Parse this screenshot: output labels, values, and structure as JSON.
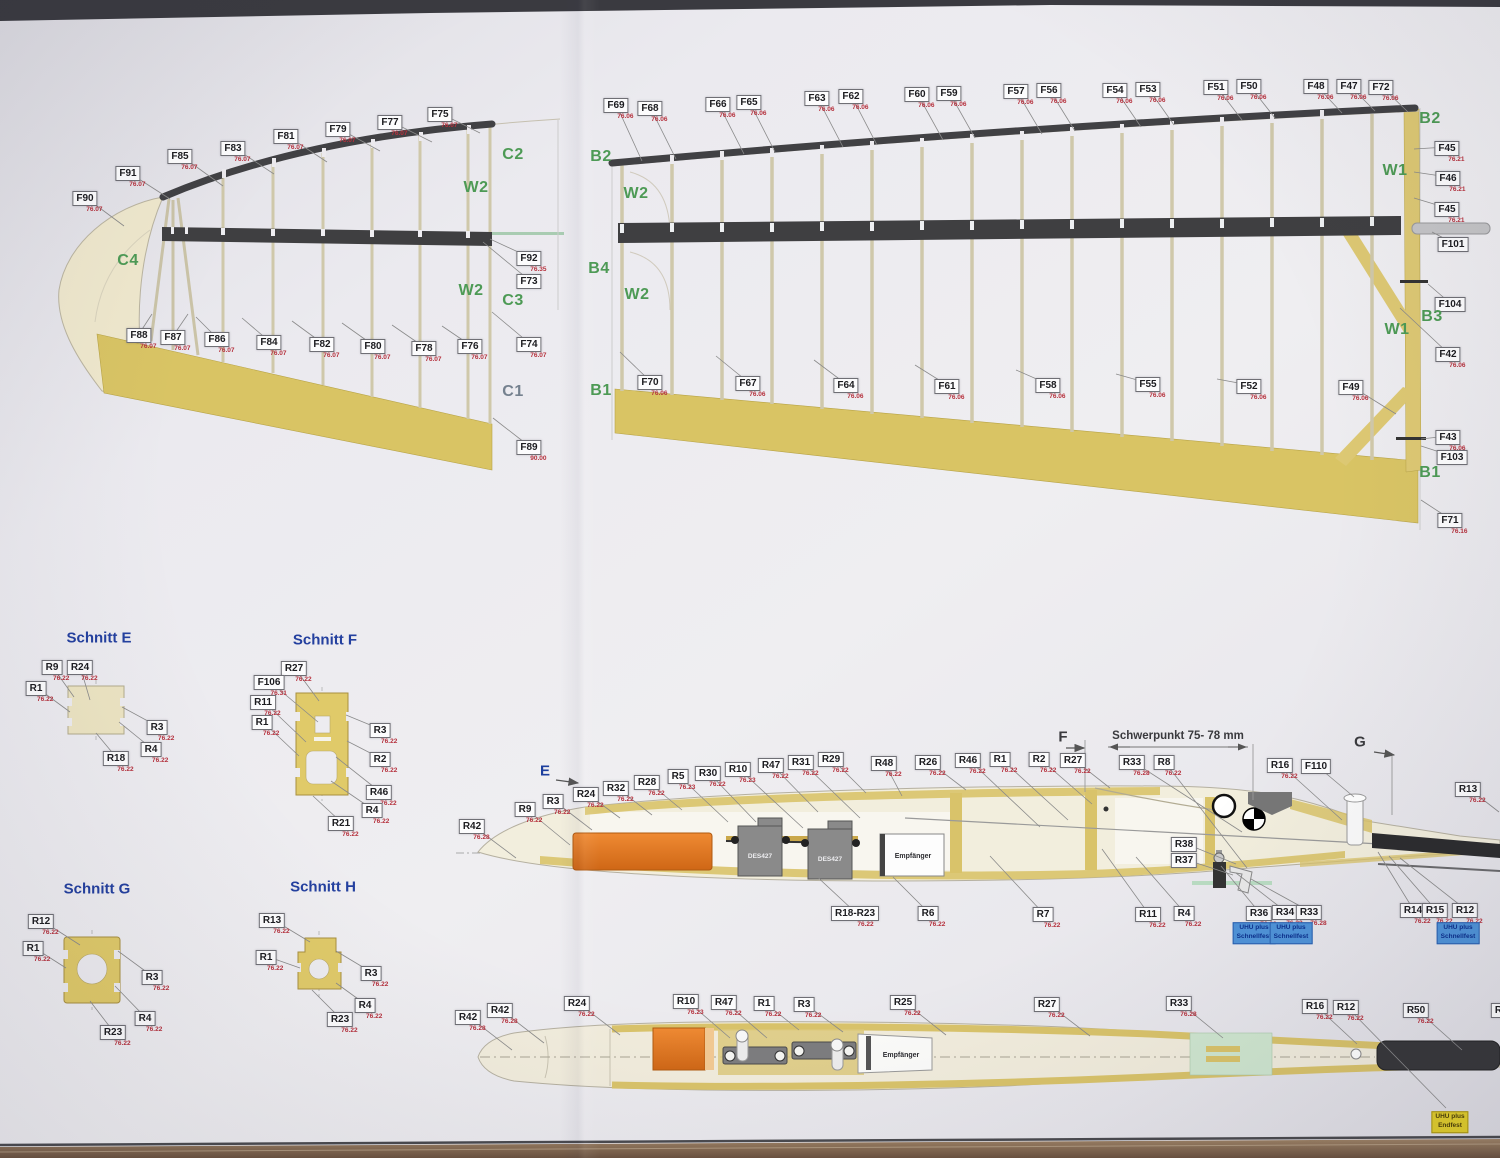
{
  "texts": {
    "servo": "DES427",
    "receiver": "Empfänger",
    "cg_dimension": "Schwerpunkt 75- 78 mm"
  },
  "section_titles": [
    {
      "label": "Schnitt E",
      "x": 99,
      "y": 638
    },
    {
      "label": "Schnitt F",
      "x": 325,
      "y": 640
    },
    {
      "label": "Schnitt G",
      "x": 97,
      "y": 889
    },
    {
      "label": "Schnitt H",
      "x": 323,
      "y": 887
    }
  ],
  "markers": [
    {
      "label": "E",
      "x": 545,
      "y": 771,
      "color": "#1d3f9e",
      "arrow": [
        556,
        780,
        578,
        783
      ]
    },
    {
      "label": "F",
      "x": 1063,
      "y": 737,
      "color": "#3a3a3e",
      "arrow": [
        1066,
        748,
        1084,
        748
      ]
    },
    {
      "label": "G",
      "x": 1360,
      "y": 742,
      "color": "#3a3a3e",
      "arrow": [
        1374,
        752,
        1394,
        755
      ]
    }
  ],
  "green_letters": [
    {
      "label": "C2",
      "x": 513,
      "y": 155,
      "color": "#4d9a55"
    },
    {
      "label": "W2",
      "x": 476,
      "y": 188,
      "color": "#4d9a55"
    },
    {
      "label": "C4",
      "x": 128,
      "y": 261,
      "color": "#4d9a55"
    },
    {
      "label": "W2",
      "x": 471,
      "y": 291,
      "color": "#4d9a55"
    },
    {
      "label": "C3",
      "x": 513,
      "y": 301,
      "color": "#4d9a55"
    },
    {
      "label": "C1",
      "x": 513,
      "y": 392,
      "color": "#75818f"
    },
    {
      "label": "B2",
      "x": 601,
      "y": 157,
      "color": "#4d9a55"
    },
    {
      "label": "W2",
      "x": 636,
      "y": 194,
      "color": "#4d9a55"
    },
    {
      "label": "B4",
      "x": 599,
      "y": 269,
      "color": "#4d9a55"
    },
    {
      "label": "W2",
      "x": 637,
      "y": 295,
      "color": "#4d9a55"
    },
    {
      "label": "B1",
      "x": 601,
      "y": 391,
      "color": "#4d9a55"
    },
    {
      "label": "B2",
      "x": 1430,
      "y": 119,
      "color": "#4d9a55"
    },
    {
      "label": "W1",
      "x": 1395,
      "y": 171,
      "color": "#4d9a55"
    },
    {
      "label": "B3",
      "x": 1432,
      "y": 317,
      "color": "#4d9a55"
    },
    {
      "label": "W1",
      "x": 1397,
      "y": 330,
      "color": "#4d9a55"
    },
    {
      "label": "B1",
      "x": 1430,
      "y": 473,
      "color": "#4d9a55"
    }
  ],
  "glue_boxes": [
    {
      "lines": [
        "UHU plus",
        "Schnellfest"
      ],
      "style": "blue",
      "x": 1254,
      "y": 933
    },
    {
      "lines": [
        "UHU plus",
        "Schnellfest"
      ],
      "style": "blue",
      "x": 1291,
      "y": 933
    },
    {
      "lines": [
        "UHU plus",
        "Schnellfest"
      ],
      "style": "blue",
      "x": 1458,
      "y": 933
    },
    {
      "lines": [
        "UHU plus",
        "Endfest"
      ],
      "style": "yellow",
      "x": 1450,
      "y": 1122
    }
  ],
  "part_labels": [
    {
      "t": "F90",
      "s": "76.07",
      "x": 85,
      "y": 197,
      "l": [
        124,
        226
      ]
    },
    {
      "t": "F91",
      "s": "76.07",
      "x": 128,
      "y": 172,
      "l": [
        170,
        199
      ]
    },
    {
      "t": "F85",
      "s": "76.07",
      "x": 180,
      "y": 155,
      "l": [
        223,
        186
      ]
    },
    {
      "t": "F83",
      "s": "76.07",
      "x": 233,
      "y": 147,
      "l": [
        274,
        174
      ]
    },
    {
      "t": "F81",
      "s": "76.07",
      "x": 286,
      "y": 135,
      "l": [
        327,
        162
      ]
    },
    {
      "t": "F79",
      "s": "76.07",
      "x": 338,
      "y": 128,
      "l": [
        380,
        151
      ]
    },
    {
      "t": "F77",
      "s": "76.07",
      "x": 390,
      "y": 121,
      "l": [
        432,
        142
      ]
    },
    {
      "t": "F75",
      "s": "76.07",
      "x": 440,
      "y": 113,
      "l": [
        480,
        133
      ]
    },
    {
      "t": "F92",
      "s": "76.35",
      "x": 529,
      "y": 257,
      "l": [
        490,
        239
      ]
    },
    {
      "t": "F73",
      "s": "",
      "x": 529,
      "y": 280,
      "l": [
        483,
        242
      ]
    },
    {
      "t": "F88",
      "s": "76.07",
      "x": 139,
      "y": 334,
      "l": [
        152,
        314
      ]
    },
    {
      "t": "F87",
      "s": "76.07",
      "x": 173,
      "y": 336,
      "l": [
        188,
        314
      ]
    },
    {
      "t": "F86",
      "s": "76.07",
      "x": 217,
      "y": 338,
      "l": [
        196,
        317
      ]
    },
    {
      "t": "F84",
      "s": "76.07",
      "x": 269,
      "y": 341,
      "l": [
        242,
        318
      ]
    },
    {
      "t": "F82",
      "s": "76.07",
      "x": 322,
      "y": 343,
      "l": [
        292,
        321
      ]
    },
    {
      "t": "F80",
      "s": "76.07",
      "x": 373,
      "y": 345,
      "l": [
        342,
        323
      ]
    },
    {
      "t": "F78",
      "s": "76.07",
      "x": 424,
      "y": 347,
      "l": [
        392,
        325
      ]
    },
    {
      "t": "F76",
      "s": "76.07",
      "x": 470,
      "y": 345,
      "l": [
        442,
        326
      ]
    },
    {
      "t": "F74",
      "s": "76.07",
      "x": 529,
      "y": 343,
      "l": [
        492,
        312
      ]
    },
    {
      "t": "F89",
      "s": "90.00",
      "x": 529,
      "y": 446,
      "l": [
        493,
        418
      ]
    },
    {
      "t": "F69",
      "s": "76.06",
      "x": 616,
      "y": 104,
      "l": [
        642,
        161
      ]
    },
    {
      "t": "F68",
      "s": "76.06",
      "x": 650,
      "y": 107,
      "l": [
        676,
        159
      ]
    },
    {
      "t": "F66",
      "s": "76.06",
      "x": 718,
      "y": 103,
      "l": [
        744,
        154
      ]
    },
    {
      "t": "F65",
      "s": "76.06",
      "x": 749,
      "y": 101,
      "l": [
        775,
        152
      ]
    },
    {
      "t": "F63",
      "s": "76.06",
      "x": 817,
      "y": 97,
      "l": [
        843,
        147
      ]
    },
    {
      "t": "F62",
      "s": "76.06",
      "x": 851,
      "y": 95,
      "l": [
        877,
        145
      ]
    },
    {
      "t": "F60",
      "s": "76.06",
      "x": 917,
      "y": 93,
      "l": [
        943,
        140
      ]
    },
    {
      "t": "F59",
      "s": "76.06",
      "x": 949,
      "y": 92,
      "l": [
        975,
        138
      ]
    },
    {
      "t": "F57",
      "s": "76.06",
      "x": 1016,
      "y": 90,
      "l": [
        1042,
        134
      ]
    },
    {
      "t": "F56",
      "s": "76.06",
      "x": 1049,
      "y": 89,
      "l": [
        1075,
        131
      ]
    },
    {
      "t": "F54",
      "s": "76.06",
      "x": 1115,
      "y": 89,
      "l": [
        1141,
        127
      ]
    },
    {
      "t": "F53",
      "s": "76.06",
      "x": 1148,
      "y": 88,
      "l": [
        1174,
        125
      ]
    },
    {
      "t": "F51",
      "s": "76.06",
      "x": 1216,
      "y": 86,
      "l": [
        1242,
        120
      ]
    },
    {
      "t": "F50",
      "s": "76.06",
      "x": 1249,
      "y": 85,
      "l": [
        1275,
        118
      ]
    },
    {
      "t": "F48",
      "s": "76.06",
      "x": 1316,
      "y": 85,
      "l": [
        1342,
        113
      ]
    },
    {
      "t": "F47",
      "s": "76.06",
      "x": 1349,
      "y": 85,
      "l": [
        1375,
        111
      ]
    },
    {
      "t": "F72",
      "s": "76.06",
      "x": 1381,
      "y": 86,
      "l": [
        1408,
        112
      ]
    },
    {
      "t": "F70",
      "s": "76.06",
      "x": 650,
      "y": 381,
      "l": [
        620,
        352
      ]
    },
    {
      "t": "F67",
      "s": "76.06",
      "x": 748,
      "y": 382,
      "l": [
        716,
        356
      ]
    },
    {
      "t": "F64",
      "s": "76.06",
      "x": 846,
      "y": 384,
      "l": [
        814,
        360
      ]
    },
    {
      "t": "F61",
      "s": "76.06",
      "x": 947,
      "y": 385,
      "l": [
        915,
        365
      ]
    },
    {
      "t": "F58",
      "s": "76.06",
      "x": 1048,
      "y": 384,
      "l": [
        1016,
        370
      ]
    },
    {
      "t": "F55",
      "s": "76.06",
      "x": 1148,
      "y": 383,
      "l": [
        1116,
        374
      ]
    },
    {
      "t": "F52",
      "s": "76.06",
      "x": 1249,
      "y": 385,
      "l": [
        1217,
        379
      ]
    },
    {
      "t": "F49",
      "s": "76.06",
      "x": 1351,
      "y": 386,
      "l": [
        1396,
        414
      ]
    },
    {
      "t": "F45",
      "s": "76.21",
      "x": 1447,
      "y": 147,
      "l": [
        1414,
        149
      ]
    },
    {
      "t": "F46",
      "s": "76.21",
      "x": 1448,
      "y": 177,
      "l": [
        1414,
        172
      ]
    },
    {
      "t": "F45",
      "s": "76.21",
      "x": 1447,
      "y": 208,
      "l": [
        1414,
        198
      ]
    },
    {
      "t": "F101",
      "s": "",
      "x": 1453,
      "y": 243,
      "l": [
        1432,
        232
      ]
    },
    {
      "t": "F104",
      "s": "",
      "x": 1450,
      "y": 303,
      "l": [
        1428,
        284
      ]
    },
    {
      "t": "F42",
      "s": "76.06",
      "x": 1448,
      "y": 353,
      "l": [
        1400,
        308
      ]
    },
    {
      "t": "F43",
      "s": "76.06",
      "x": 1448,
      "y": 436,
      "l": [
        1421,
        439
      ]
    },
    {
      "t": "F103",
      "s": "",
      "x": 1452,
      "y": 456,
      "l": [
        1421,
        446
      ]
    },
    {
      "t": "F71",
      "s": "76.16",
      "x": 1450,
      "y": 519,
      "l": [
        1421,
        500
      ]
    },
    {
      "t": "R9",
      "s": "76.22",
      "x": 52,
      "y": 666,
      "l": [
        74,
        697
      ]
    },
    {
      "t": "R24",
      "s": "76.22",
      "x": 80,
      "y": 666,
      "l": [
        90,
        700
      ]
    },
    {
      "t": "R1",
      "s": "76.22",
      "x": 36,
      "y": 687,
      "l": [
        70,
        712
      ]
    },
    {
      "t": "R3",
      "s": "76.22",
      "x": 157,
      "y": 726,
      "l": [
        122,
        707
      ]
    },
    {
      "t": "R4",
      "s": "76.22",
      "x": 151,
      "y": 748,
      "l": [
        119,
        722
      ]
    },
    {
      "t": "R18",
      "s": "76.22",
      "x": 116,
      "y": 757,
      "l": [
        96,
        733
      ]
    },
    {
      "t": "R27",
      "s": "76.22",
      "x": 294,
      "y": 667,
      "l": [
        319,
        701
      ]
    },
    {
      "t": "F106",
      "s": "76.31",
      "x": 269,
      "y": 681,
      "l": [
        318,
        722
      ]
    },
    {
      "t": "R11",
      "s": "76.22",
      "x": 263,
      "y": 701,
      "l": [
        306,
        742
      ]
    },
    {
      "t": "R1",
      "s": "76.22",
      "x": 262,
      "y": 721,
      "l": [
        299,
        756
      ]
    },
    {
      "t": "R3",
      "s": "76.22",
      "x": 380,
      "y": 729,
      "l": [
        346,
        715
      ]
    },
    {
      "t": "R2",
      "s": "76.22",
      "x": 380,
      "y": 758,
      "l": [
        347,
        741
      ]
    },
    {
      "t": "R46",
      "s": "76.22",
      "x": 379,
      "y": 791,
      "l": [
        336,
        757
      ]
    },
    {
      "t": "R4",
      "s": "76.22",
      "x": 372,
      "y": 809,
      "l": [
        331,
        781
      ]
    },
    {
      "t": "R21",
      "s": "76.22",
      "x": 341,
      "y": 822,
      "l": [
        313,
        796
      ]
    },
    {
      "t": "R12",
      "s": "76.22",
      "x": 41,
      "y": 920,
      "l": [
        80,
        945
      ]
    },
    {
      "t": "R1",
      "s": "76.22",
      "x": 33,
      "y": 947,
      "l": [
        66,
        968
      ]
    },
    {
      "t": "R3",
      "s": "76.22",
      "x": 152,
      "y": 976,
      "l": [
        118,
        951
      ]
    },
    {
      "t": "R4",
      "s": "76.22",
      "x": 145,
      "y": 1017,
      "l": [
        115,
        986
      ]
    },
    {
      "t": "R23",
      "s": "76.22",
      "x": 113,
      "y": 1031,
      "l": [
        90,
        1001
      ]
    },
    {
      "t": "R13",
      "s": "76.22",
      "x": 272,
      "y": 919,
      "l": [
        310,
        942
      ]
    },
    {
      "t": "R1",
      "s": "76.22",
      "x": 266,
      "y": 956,
      "l": [
        300,
        968
      ]
    },
    {
      "t": "R3",
      "s": "76.22",
      "x": 371,
      "y": 972,
      "l": [
        336,
        951
      ]
    },
    {
      "t": "R4",
      "s": "76.22",
      "x": 365,
      "y": 1004,
      "l": [
        336,
        983
      ]
    },
    {
      "t": "R23",
      "s": "76.22",
      "x": 340,
      "y": 1018,
      "l": [
        312,
        990
      ]
    },
    {
      "t": "R42",
      "s": "76.28",
      "x": 472,
      "y": 825,
      "l": [
        516,
        858
      ]
    },
    {
      "t": "R9",
      "s": "76.22",
      "x": 525,
      "y": 808,
      "l": [
        570,
        845
      ]
    },
    {
      "t": "R3",
      "s": "76.22",
      "x": 553,
      "y": 800,
      "l": [
        592,
        830
      ]
    },
    {
      "t": "R24",
      "s": "76.22",
      "x": 586,
      "y": 793,
      "l": [
        620,
        818
      ]
    },
    {
      "t": "R32",
      "s": "76.22",
      "x": 616,
      "y": 787,
      "l": [
        652,
        815
      ]
    },
    {
      "t": "R28",
      "s": "76.22",
      "x": 647,
      "y": 781,
      "l": [
        682,
        810
      ]
    },
    {
      "t": "R5",
      "s": "76.23",
      "x": 678,
      "y": 775,
      "l": [
        728,
        822
      ]
    },
    {
      "t": "R30",
      "s": "76.22",
      "x": 708,
      "y": 772,
      "l": [
        756,
        822
      ]
    },
    {
      "t": "R10",
      "s": "76.23",
      "x": 738,
      "y": 768,
      "l": [
        803,
        828
      ]
    },
    {
      "t": "R47",
      "s": "76.22",
      "x": 771,
      "y": 764,
      "l": [
        818,
        812
      ]
    },
    {
      "t": "R31",
      "s": "76.22",
      "x": 801,
      "y": 761,
      "l": [
        860,
        818
      ]
    },
    {
      "t": "R29",
      "s": "76.22",
      "x": 831,
      "y": 758,
      "l": [
        866,
        793
      ]
    },
    {
      "t": "R48",
      "s": "76.22",
      "x": 884,
      "y": 762,
      "l": [
        902,
        796
      ]
    },
    {
      "t": "R26",
      "s": "76.22",
      "x": 928,
      "y": 761,
      "l": [
        966,
        790
      ]
    },
    {
      "t": "R46",
      "s": "76.22",
      "x": 968,
      "y": 759,
      "l": [
        1040,
        827
      ]
    },
    {
      "t": "R1",
      "s": "76.22",
      "x": 1000,
      "y": 758,
      "l": [
        1068,
        820
      ]
    },
    {
      "t": "R2",
      "s": "76.22",
      "x": 1039,
      "y": 758,
      "l": [
        1092,
        804
      ]
    },
    {
      "t": "R27",
      "s": "76.22",
      "x": 1073,
      "y": 759,
      "l": [
        1110,
        788
      ]
    },
    {
      "t": "R33",
      "s": "76.28",
      "x": 1132,
      "y": 761,
      "l": [
        1242,
        832
      ]
    },
    {
      "t": "R8",
      "s": "76.22",
      "x": 1164,
      "y": 761,
      "l": [
        1247,
        868
      ]
    },
    {
      "t": "R16",
      "s": "76.22",
      "x": 1280,
      "y": 764,
      "l": [
        1342,
        820
      ]
    },
    {
      "t": "F110",
      "s": "",
      "x": 1316,
      "y": 765,
      "l": [
        1354,
        797
      ]
    },
    {
      "t": "R13",
      "s": "76.22",
      "x": 1468,
      "y": 788,
      "l": [
        1499,
        812
      ]
    },
    {
      "t": "R18-R23",
      "s": "76.22",
      "x": 855,
      "y": 912,
      "l": [
        812,
        872
      ]
    },
    {
      "t": "R6",
      "s": "76.22",
      "x": 928,
      "y": 912,
      "l": [
        893,
        877
      ]
    },
    {
      "t": "R7",
      "s": "76.22",
      "x": 1043,
      "y": 913,
      "l": [
        990,
        856
      ]
    },
    {
      "t": "R11",
      "s": "76.22",
      "x": 1148,
      "y": 913,
      "l": [
        1102,
        849
      ]
    },
    {
      "t": "R4",
      "s": "76.22",
      "x": 1184,
      "y": 912,
      "l": [
        1136,
        857
      ]
    },
    {
      "t": "R38",
      "s": "",
      "x": 1184,
      "y": 843,
      "l": [
        1236,
        864
      ]
    },
    {
      "t": "R37",
      "s": "",
      "x": 1184,
      "y": 859,
      "l": [
        1233,
        875
      ]
    },
    {
      "t": "R36",
      "s": "76.22",
      "x": 1259,
      "y": 912,
      "l": [
        1221,
        866
      ]
    },
    {
      "t": "R34",
      "s": "76.22",
      "x": 1285,
      "y": 911,
      "l": [
        1236,
        873
      ]
    },
    {
      "t": "R33",
      "s": "76.28",
      "x": 1309,
      "y": 911,
      "l": [
        1251,
        879
      ]
    },
    {
      "t": "R14",
      "s": "76.22",
      "x": 1413,
      "y": 909,
      "l": [
        1378,
        852
      ]
    },
    {
      "t": "R15",
      "s": "76.22",
      "x": 1435,
      "y": 909,
      "l": [
        1389,
        856
      ]
    },
    {
      "t": "R12",
      "s": "76.22",
      "x": 1465,
      "y": 909,
      "l": [
        1400,
        858
      ]
    },
    {
      "t": "R42",
      "s": "76.28",
      "x": 468,
      "y": 1016,
      "l": [
        512,
        1050
      ]
    },
    {
      "t": "R42",
      "s": "76.28",
      "x": 500,
      "y": 1009,
      "l": [
        544,
        1043
      ]
    },
    {
      "t": "R24",
      "s": "76.22",
      "x": 577,
      "y": 1002,
      "l": [
        620,
        1035
      ]
    },
    {
      "t": "R10",
      "s": "76.23",
      "x": 686,
      "y": 1000,
      "l": [
        730,
        1038
      ]
    },
    {
      "t": "R47",
      "s": "76.22",
      "x": 724,
      "y": 1001,
      "l": [
        767,
        1038
      ]
    },
    {
      "t": "R1",
      "s": "76.22",
      "x": 764,
      "y": 1002,
      "l": [
        799,
        1030
      ]
    },
    {
      "t": "R3",
      "s": "76.22",
      "x": 804,
      "y": 1003,
      "l": [
        843,
        1032
      ]
    },
    {
      "t": "R25",
      "s": "76.22",
      "x": 903,
      "y": 1001,
      "l": [
        946,
        1035
      ]
    },
    {
      "t": "R27",
      "s": "76.22",
      "x": 1047,
      "y": 1003,
      "l": [
        1090,
        1036
      ]
    },
    {
      "t": "R33",
      "s": "76.28",
      "x": 1179,
      "y": 1002,
      "l": [
        1223,
        1038
      ]
    },
    {
      "t": "R16",
      "s": "76.22",
      "x": 1315,
      "y": 1005,
      "l": [
        1357,
        1044
      ]
    },
    {
      "t": "R12",
      "s": "76.22",
      "x": 1346,
      "y": 1006,
      "l": [
        1446,
        1108
      ]
    },
    {
      "t": "R50",
      "s": "76.22",
      "x": 1416,
      "y": 1009,
      "l": [
        1462,
        1050
      ]
    },
    {
      "t": "R13",
      "s": "76.22",
      "x": 1504,
      "y": 1009
    }
  ]
}
